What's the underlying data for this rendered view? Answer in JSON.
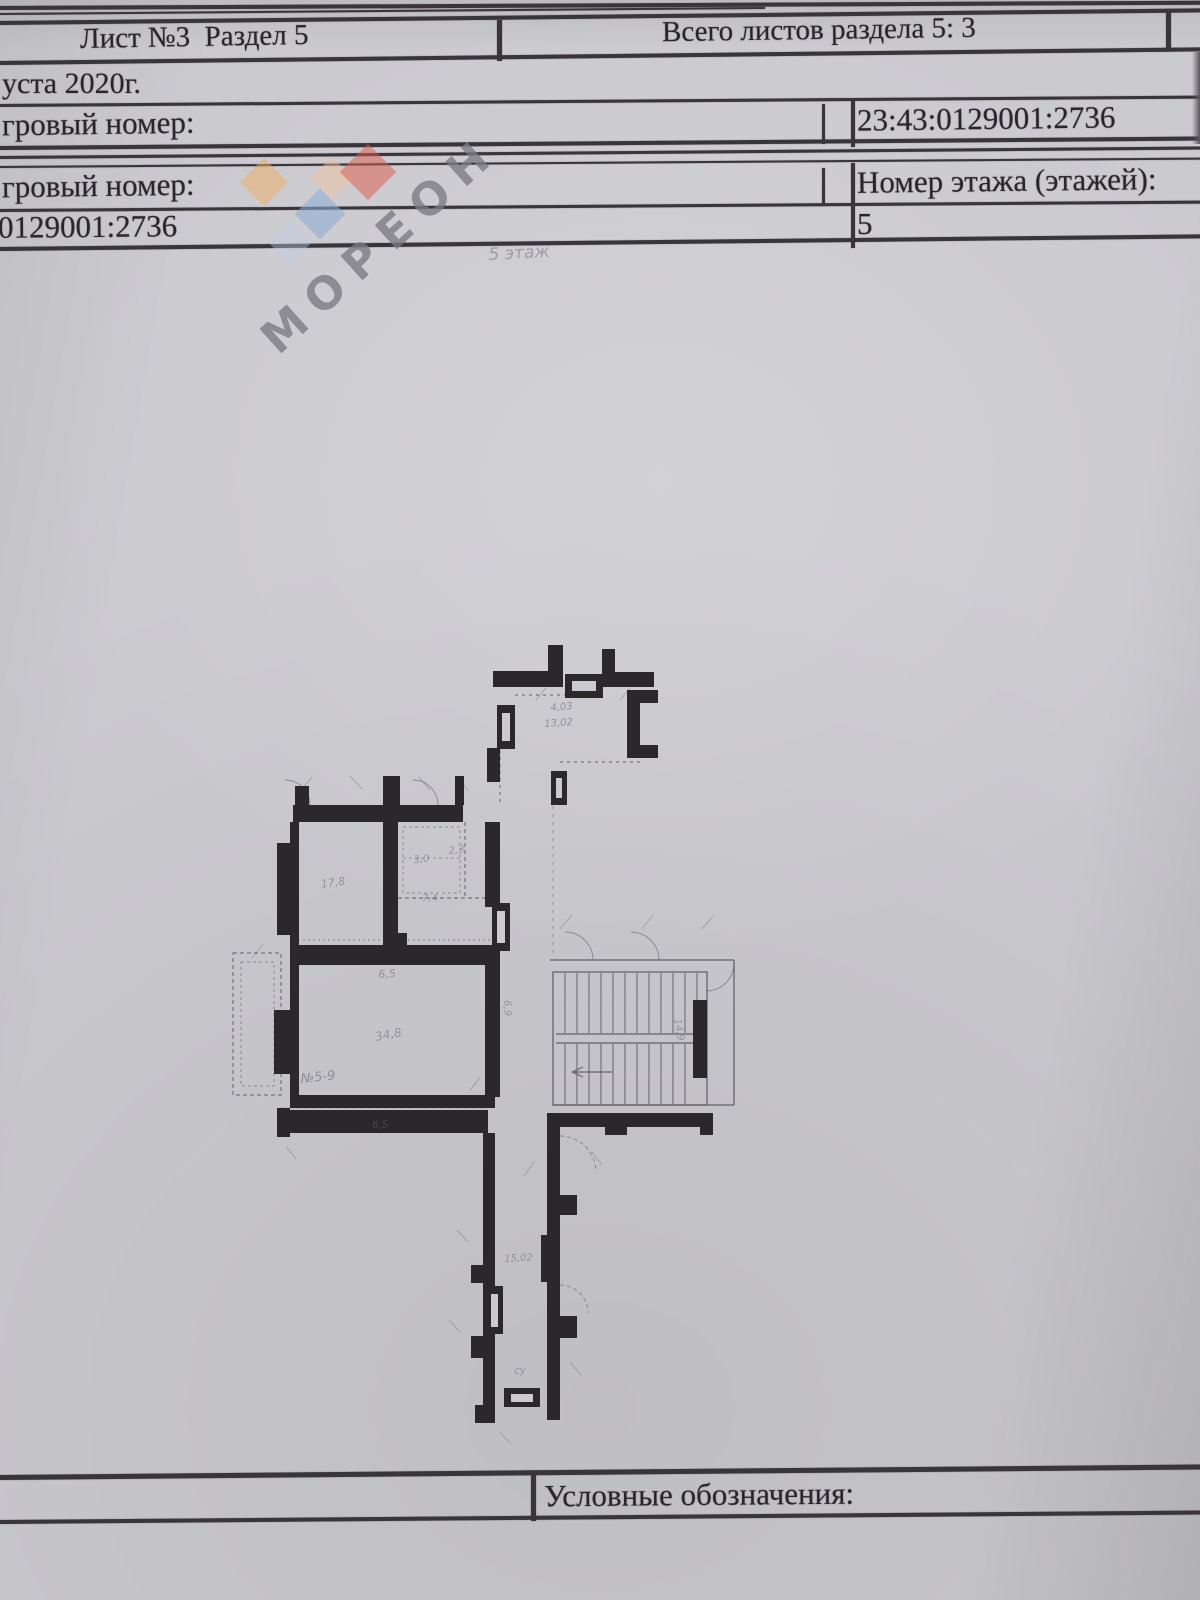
{
  "document": {
    "header": {
      "sheet_section": "Лист №3  Раздел 5",
      "total_sheets": "Всего листов раздела 5: 3"
    },
    "date_fragment": "уста 2020г.",
    "cadastral_row": {
      "label": "гровый номер:",
      "value": "23:43:0129001:2736"
    },
    "floor_row": {
      "label": "гровый номер:",
      "floor_label": "Номер этажа (этажей):",
      "cadastral_value": "0129001:2736",
      "floor_value": "5"
    },
    "legend_label": "Условные обозначения:"
  },
  "watermark": {
    "text": "МОРЕОН",
    "accent_colors": [
      "#f0ad63",
      "#f4c39b",
      "#e05a4b",
      "#8cadd6",
      "#bccde6"
    ],
    "diamonds": [
      {
        "x": 264,
        "y": 182,
        "size": 34,
        "color": "#f0ad63",
        "opacity": 0.5
      },
      {
        "x": 332,
        "y": 178,
        "size": 30,
        "color": "#f4c39b",
        "opacity": 0.45
      },
      {
        "x": 368,
        "y": 172,
        "size": 40,
        "color": "#e05a4b",
        "opacity": 0.5
      },
      {
        "x": 320,
        "y": 214,
        "size": 36,
        "color": "#8cadd6",
        "opacity": 0.55
      },
      {
        "x": 290,
        "y": 243,
        "size": 30,
        "color": "#bccde6",
        "opacity": 0.4
      }
    ]
  },
  "plan": {
    "annotations": [
      {
        "text": "5 этаж",
        "x": 488,
        "y": 245,
        "size": 17,
        "rot": -3,
        "opacity": 0.45
      },
      {
        "text": "4,03",
        "x": 550,
        "y": 703,
        "size": 10,
        "rot": -5,
        "opacity": 0.55
      },
      {
        "text": "13,02",
        "x": 544,
        "y": 719,
        "size": 10,
        "rot": -4,
        "opacity": 0.55
      },
      {
        "text": "17,8",
        "x": 320,
        "y": 878,
        "size": 11,
        "rot": -8,
        "opacity": 0.5
      },
      {
        "text": "3,0",
        "x": 413,
        "y": 855,
        "size": 10,
        "rot": -5,
        "opacity": 0.5
      },
      {
        "text": "2,3",
        "x": 448,
        "y": 846,
        "size": 10,
        "rot": -6,
        "opacity": 0.5
      },
      {
        "text": "7,4",
        "x": 422,
        "y": 893,
        "size": 10,
        "rot": 0,
        "opacity": 0.5
      },
      {
        "text": "6,5",
        "x": 378,
        "y": 968,
        "size": 11,
        "rot": -3,
        "opacity": 0.5
      },
      {
        "text": "34,8",
        "x": 374,
        "y": 1030,
        "size": 12,
        "rot": -10,
        "opacity": 0.5
      },
      {
        "text": "№5-9",
        "x": 300,
        "y": 1072,
        "size": 13,
        "rot": -6,
        "opacity": 0.55
      },
      {
        "text": "6,5",
        "x": 372,
        "y": 1120,
        "size": 10,
        "rot": -2,
        "opacity": 0.5
      },
      {
        "text": "6,9",
        "x": 512,
        "y": 1000,
        "size": 10,
        "rot": 88,
        "opacity": 0.5
      },
      {
        "text": "15,02",
        "x": 504,
        "y": 1254,
        "size": 10,
        "rot": -3,
        "opacity": 0.5
      },
      {
        "text": "су",
        "x": 514,
        "y": 1366,
        "size": 10,
        "rot": -4,
        "opacity": 0.5
      },
      {
        "text": "14,9",
        "x": 682,
        "y": 1018,
        "size": 10,
        "rot": 80,
        "opacity": 0.5
      }
    ]
  }
}
